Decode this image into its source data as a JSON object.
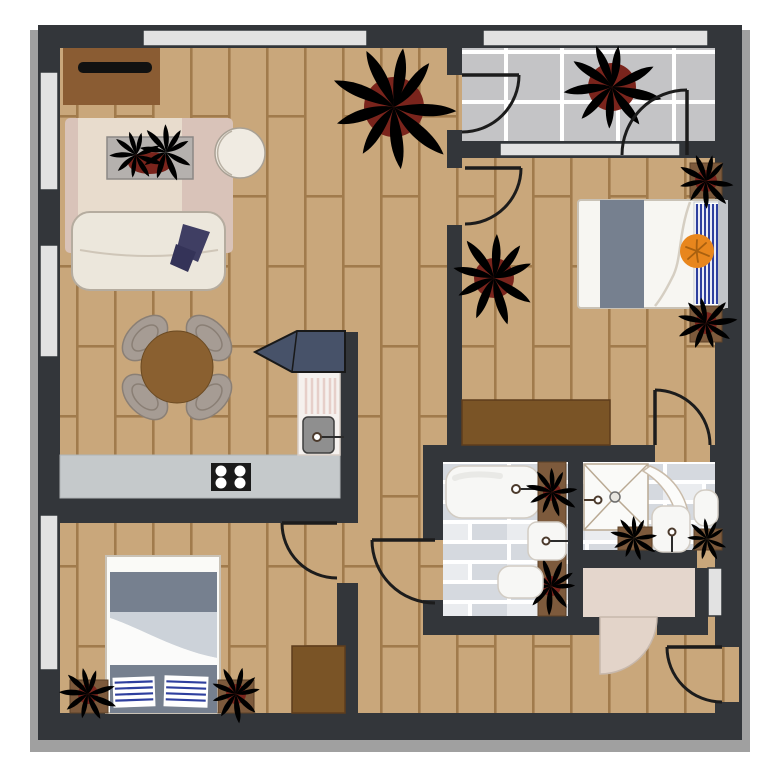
{
  "title": "Apartment floor plan (top-down view)",
  "type": "floor-plan-diagram",
  "colors": {
    "wall": "#33363a",
    "shadow": "#a0a0a0",
    "wood": "#c9a77b",
    "woodLine": "#a17b4c",
    "balconyTile": "#c4c4c6",
    "tileLine": "#ffffff",
    "brick": "#d5d9df",
    "brickLight": "#eaecef",
    "grout": "#ffffff",
    "glass": "#e2e2e2",
    "rugBase": "#d9c3b9",
    "rugInner": "#e8dccd",
    "sofa": "#ece7dc",
    "sofaLine": "#b5ac9f",
    "blanket": "#3f3e63",
    "blanketDark": "#343358",
    "tableBrown": "#8a6030",
    "chairGray": "#a69c94",
    "chairLine": "#8a7f75",
    "counter": "#c5c9cb",
    "stove": "#1a1a1a",
    "burner": "#ffffff",
    "cabinetSlate": "#475269",
    "sinkWhite": "#f5f1ee",
    "sinkStripe": "#e6cfc9",
    "basin": "#8f8f8f",
    "fixtureWhite": "#f7f7f5",
    "fixtureLine": "#d2ccc3",
    "showerLine": "#b9a993",
    "planter": "#7d5a3c",
    "pot": "#7a241c",
    "leafD1": "#1c681e",
    "leafD2": "#2d9023",
    "leafB1": "#1f9e1f",
    "leafB2": "#49d42e",
    "bedGray": "#76808f",
    "duvetShade": "#ccd2d9",
    "stripeBlue": "#2e3f9e",
    "orange": "#e8861d",
    "orangeLine": "#a9600f",
    "wardrobe": "#7a5426",
    "tvBrown": "#8a5c33",
    "tvScreen": "#111111",
    "entryBeige": "#e4d6cc",
    "entryDoor": "#e3d4c9",
    "entryDoorLine": "#c7b8ac",
    "doorLine": "#1c1c1c"
  },
  "rooms": [
    {
      "name": "living-room",
      "floor": "wood",
      "furniture": [
        "tv-stand",
        "area-rug",
        "coffee-table-with-plants",
        "round-side-table",
        "sofa",
        "throw-blanket",
        "dining-table",
        "four-chairs",
        "large-potted-plant"
      ]
    },
    {
      "name": "kitchen",
      "floor": "wood",
      "furniture": [
        "counter",
        "cooktop",
        "sink-with-drainboard",
        "tall-cabinet"
      ]
    },
    {
      "name": "balcony",
      "floor": "tile",
      "furniture": [
        "potted-plant"
      ]
    },
    {
      "name": "bedroom-right",
      "floor": "wood",
      "furniture": [
        "double-bed",
        "striped-runner",
        "orange-cushion",
        "wardrobe",
        "potted-plant",
        "potted-plant",
        "potted-plant"
      ]
    },
    {
      "name": "bathroom",
      "floor": "brick-tile",
      "furniture": [
        "bathtub",
        "washbasin",
        "toilet",
        "planter-with-plants"
      ]
    },
    {
      "name": "shower-room",
      "floor": "brick-tile",
      "furniture": [
        "corner-shower",
        "shower-door",
        "toilet",
        "washbasin",
        "planter-with-plants"
      ]
    },
    {
      "name": "entry-hall",
      "floor": "beige",
      "furniture": []
    },
    {
      "name": "bedroom-bottom-left",
      "floor": "wood",
      "furniture": [
        "double-bed",
        "striped-cushions",
        "dresser",
        "potted-plant",
        "potted-plant"
      ]
    },
    {
      "name": "hallway",
      "floor": "wood",
      "furniture": [
        "potted-plant"
      ]
    }
  ],
  "openings": {
    "doors": [
      "living-to-balcony",
      "balcony-right",
      "hall-to-bedroom-right",
      "bedroom-right-to-shower-room",
      "hall-to-bedroom-bottom-left",
      "hall-to-bathroom",
      "entry-hall-inner-door",
      "front-door"
    ],
    "windows": [
      "left-wall-upper",
      "left-wall-middle",
      "left-wall-lower",
      "top-wall-living",
      "top-wall-balcony",
      "balcony-to-bedroom",
      "entry-right-wall"
    ]
  },
  "counts": {
    "plants": 12,
    "doors": 8,
    "windows": 7
  }
}
